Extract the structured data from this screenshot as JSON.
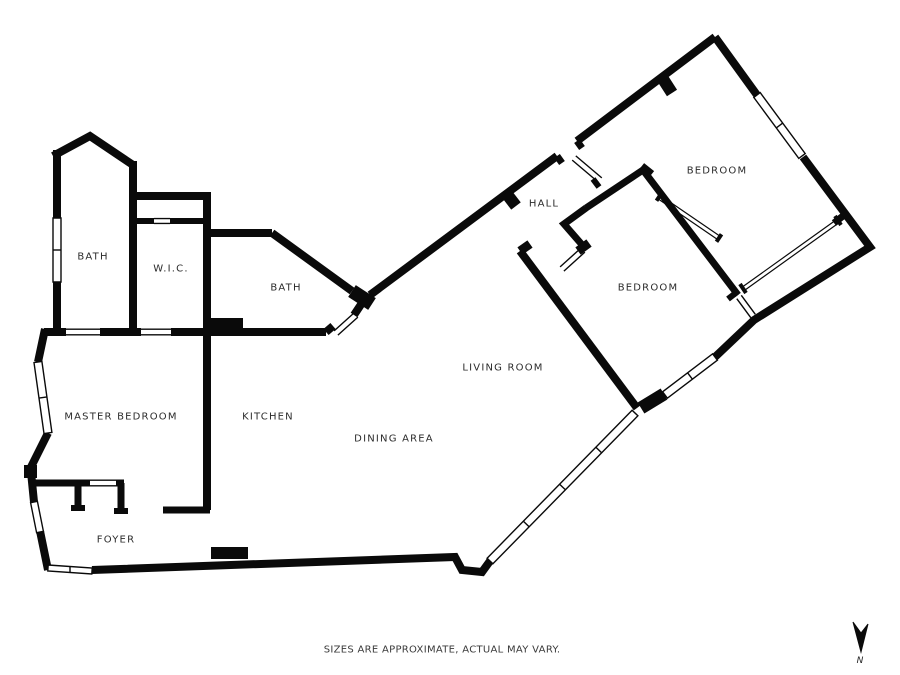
{
  "floorplan": {
    "title": "apartment-floor-plan",
    "rooms": [
      {
        "name": "bath-1",
        "label": "BATH"
      },
      {
        "name": "wic",
        "label": "W.I.C."
      },
      {
        "name": "bath-2",
        "label": "BATH"
      },
      {
        "name": "hall",
        "label": "HALL"
      },
      {
        "name": "bedroom-1",
        "label": "BEDROOM"
      },
      {
        "name": "bedroom-2",
        "label": "BEDROOM"
      },
      {
        "name": "living-room",
        "label": "LIVING ROOM"
      },
      {
        "name": "master-bedroom",
        "label": "MASTER BEDROOM"
      },
      {
        "name": "kitchen",
        "label": "KITCHEN"
      },
      {
        "name": "dining-area",
        "label": "DINING AREA"
      },
      {
        "name": "foyer",
        "label": "FOYER"
      }
    ],
    "footnote": "SIZES ARE APPROXIMATE, ACTUAL MAY VARY.",
    "compass": {
      "label": "N",
      "direction": "down"
    },
    "colors": {
      "wall": "#0a0a0a",
      "background": "#ffffff",
      "label": "#2b2b2b"
    }
  }
}
